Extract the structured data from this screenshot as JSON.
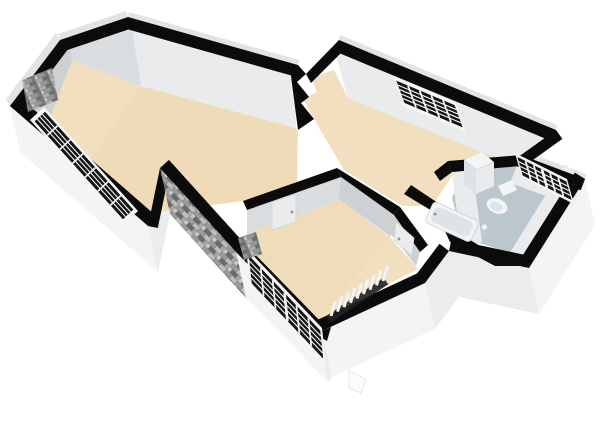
{
  "scene": {
    "type": "isometric-3d-floorplan-render",
    "rooms": [
      {
        "name": "living-room",
        "floor": "floor_wood"
      },
      {
        "name": "back-bedroom",
        "floor": "floor_wood"
      },
      {
        "name": "front-bedroom",
        "floor": "floor_wood"
      },
      {
        "name": "bathroom",
        "floor": "floor_tile"
      }
    ],
    "windows": [
      {
        "name": "living-room-front-window",
        "cols": 7,
        "rows": 4
      },
      {
        "name": "front-bay-window",
        "cols": 6,
        "rows": 5
      },
      {
        "name": "back-bedroom-window",
        "cols": 5,
        "rows": 5
      },
      {
        "name": "bathroom-window",
        "cols": 6,
        "rows": 4
      }
    ],
    "fixtures": [
      "bathtub",
      "toilet",
      "bathroom-cabinet",
      "toilet-brush",
      "radiator",
      "brick-chimney-panel",
      "brick-corner-panel",
      "door-living-bedroom",
      "door-bedroom-hall",
      "exterior-step"
    ]
  },
  "colors": {
    "background": "#ffffff",
    "wall_top": "#0b0b0b",
    "wall_inner_light": "#e9ebec",
    "wall_inner_mid": "#dadddf",
    "wall_inner_dark": "#cdd1d4",
    "wall_outer": "#f3f4f5",
    "wall_outer_shade": "#eaeced",
    "wall_outer_strip": "#e1e3e4",
    "floor_wood": "#f1dfbf",
    "floor_wood_deep": "#ead4ad",
    "floor_tile": "#bcc6cd",
    "window_frame": "#f6f6f6",
    "window_glass": "#141414",
    "brick_base": "#8a8a8a",
    "fixture_white": "#f2f4f5",
    "fixture_shade": "#dfe3e5",
    "fixture_line": "#cdd2d5",
    "handle_grey": "#8a9096",
    "radiator_dark": "#222222"
  }
}
